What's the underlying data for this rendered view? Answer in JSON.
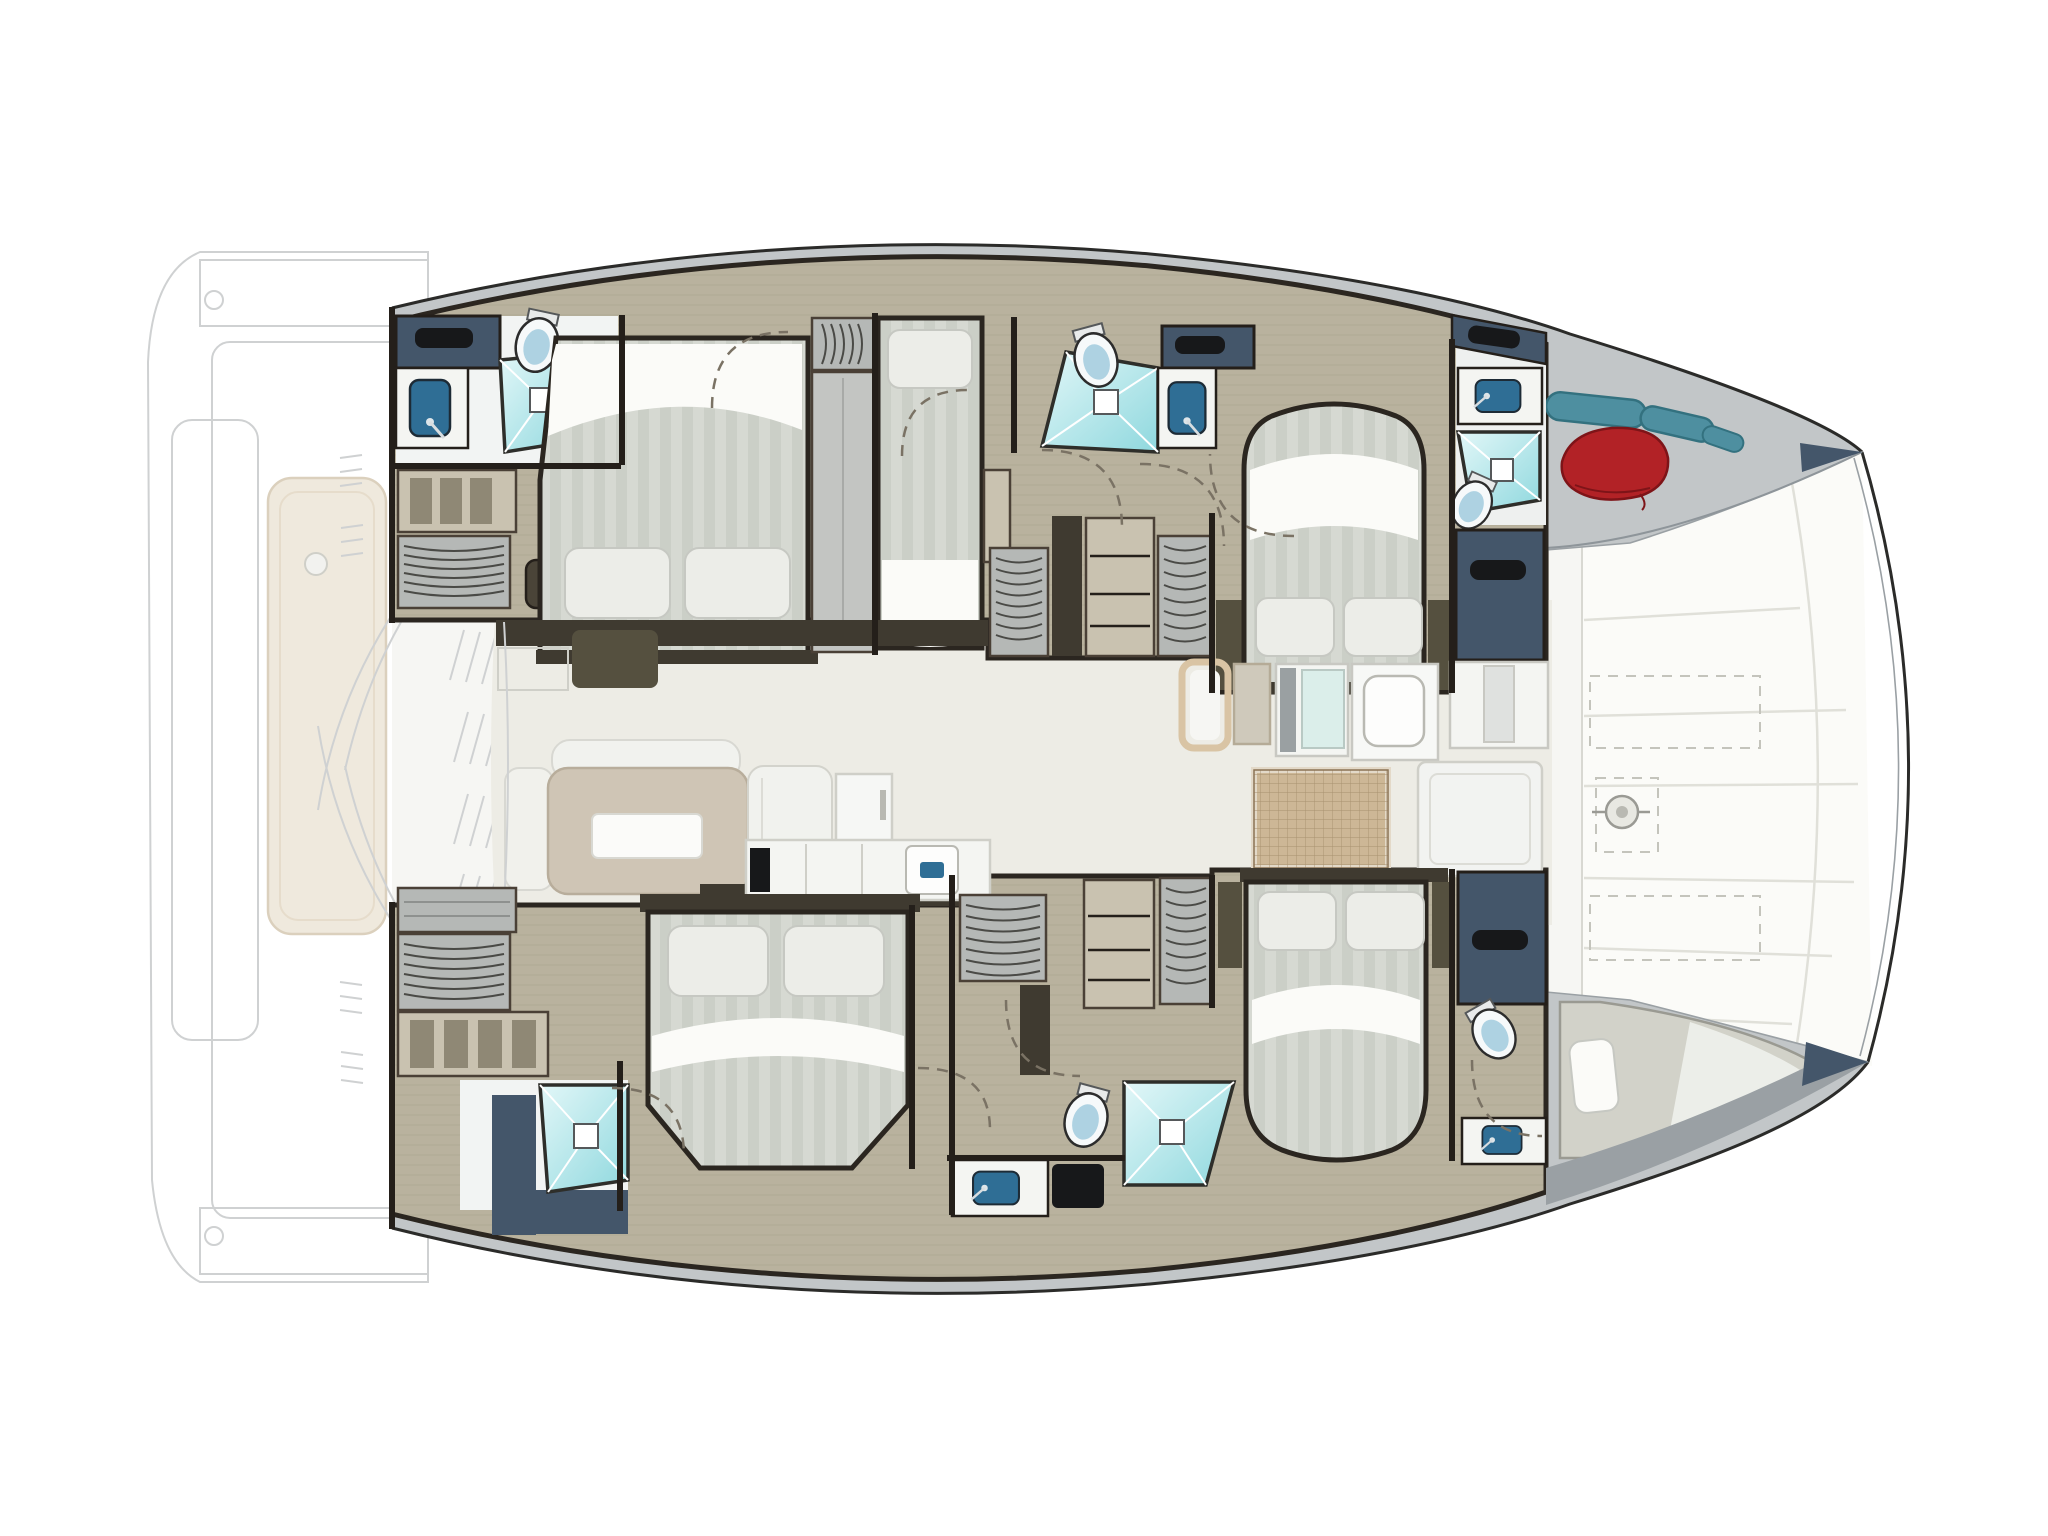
{
  "image": {
    "kind": "catamaran-yacht-floorplan",
    "orientation": "bow-right-stern-left",
    "view": "top-down interior deck plan"
  },
  "colors": {
    "outline": "#2b2b29",
    "deck_gray": "#c2c6c8",
    "deck_gray_dark": "#9aa0a4",
    "foredeck": "#fbfbf8",
    "seam": "#e0e0d9",
    "saloon_floor": "#edece5",
    "cockpit_floor": "#f6f6f3",
    "wood": "#b9b29e",
    "wood_grain": "#a9a28c",
    "wall": "#241f1a",
    "wall_mid": "#3a352c",
    "trim": "#4a4036",
    "navy": "#44566a",
    "navy_dark": "#17181a",
    "teal_light": "#e2f7f8",
    "teal": "#8fd8de",
    "toilet_white": "#f6f9fa",
    "toilet_blue": "#aed2e2",
    "sink_navy": "#2f6e95",
    "counter_white": "#f4f5f2",
    "counter_line": "#cfcfc8",
    "mattress": "#d6d9d2",
    "mattress_stripe": "#cbcfc7",
    "sheet": "#fbfbf8",
    "pillow": "#ecede8",
    "pillow_line": "#c6c8c2",
    "frame_dark": "#2b2620",
    "sofa": "#cfc5b5",
    "settee": "#f1f2ee",
    "cabinet_olive": "#55503f",
    "cabinet_band": "#3f3a30",
    "cabinet_gray": "#b5b8b6",
    "shelf_tan": "#c9c2b0",
    "shelf_slot": "#8f8875",
    "hanger_line": "#4a4a46",
    "mat": "#cdb796",
    "mat_grid": "#a8906f",
    "mat_border": "#e3d9c8",
    "red_bag": "#b22226",
    "red_bag_dark": "#7e1418",
    "fender_teal": "#4e8fa0",
    "fender_dark": "#33717f",
    "berth": "#d2d2c9",
    "faint": "#cfd1d2",
    "faint_fill": "#fbfbfa",
    "lounger": "#efe9dd",
    "lounger_line": "#dbd0bd",
    "arc": "#7a7264",
    "glass_teal": "#dbeeea"
  },
  "features": {
    "hulls": 2,
    "double_berths": 4,
    "single_berths": 1,
    "bow_crew_berth": 1,
    "shower_stalls": 5,
    "toilets": 5,
    "sinks": 5,
    "hanging_wardrobes": 7,
    "shelf_units": 4,
    "saloon_items": [
      "sofa",
      "coffee-table",
      "chaise",
      "settee",
      "refrigerator",
      "galley-counters",
      "galley-sink",
      "nav-seat",
      "woven-floor-mat"
    ],
    "foredeck_items": [
      "trampoline-panels",
      "anchor-windlass",
      "deck-lockers",
      "fenders",
      "fender-bag"
    ],
    "aft_deck_items": [
      "cockpit-platform",
      "sun-lounger"
    ]
  }
}
